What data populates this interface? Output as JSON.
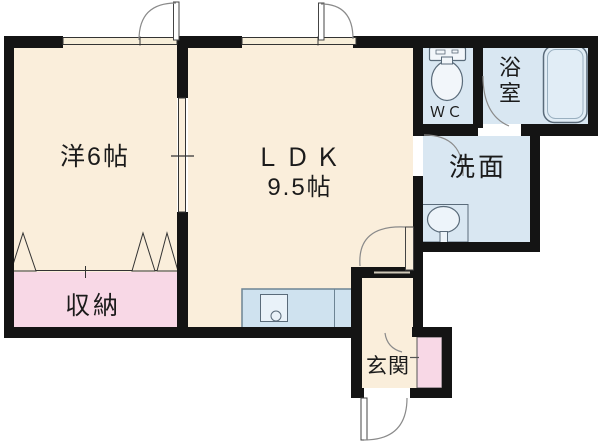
{
  "plan_title": "1LDK apartment floor plan",
  "rooms": {
    "western": {
      "label": "洋6帖"
    },
    "ldk": {
      "label": "ＬＤＫ",
      "size": "9.5帖"
    },
    "wc": {
      "label": "ＷＣ"
    },
    "bath": {
      "char1": "浴",
      "char2": "室"
    },
    "washroom": {
      "label": "洗面"
    },
    "storage": {
      "label": "収納"
    },
    "entrance": {
      "label": "玄関"
    }
  },
  "fixtures": [
    "toilet",
    "bathtub",
    "washbasin",
    "kitchen-counter",
    "closet-bifold-doors"
  ],
  "doors": [
    "western-room-top-door",
    "ldk-top-door",
    "washroom-door",
    "bathroom-door",
    "ldk-hall-door",
    "entrance-door",
    "shoe-closet-door"
  ],
  "colors": {
    "wall": "#141414",
    "floor_cream": "#faeedb",
    "wet_area_blue": "#d9e7f2",
    "closet_pink": "#f8d8e6",
    "fixture_line": "#5a6b7a",
    "counter_fill": "#cfe2ef",
    "arc_line": "#8a8a8a",
    "background": "#ffffff"
  }
}
